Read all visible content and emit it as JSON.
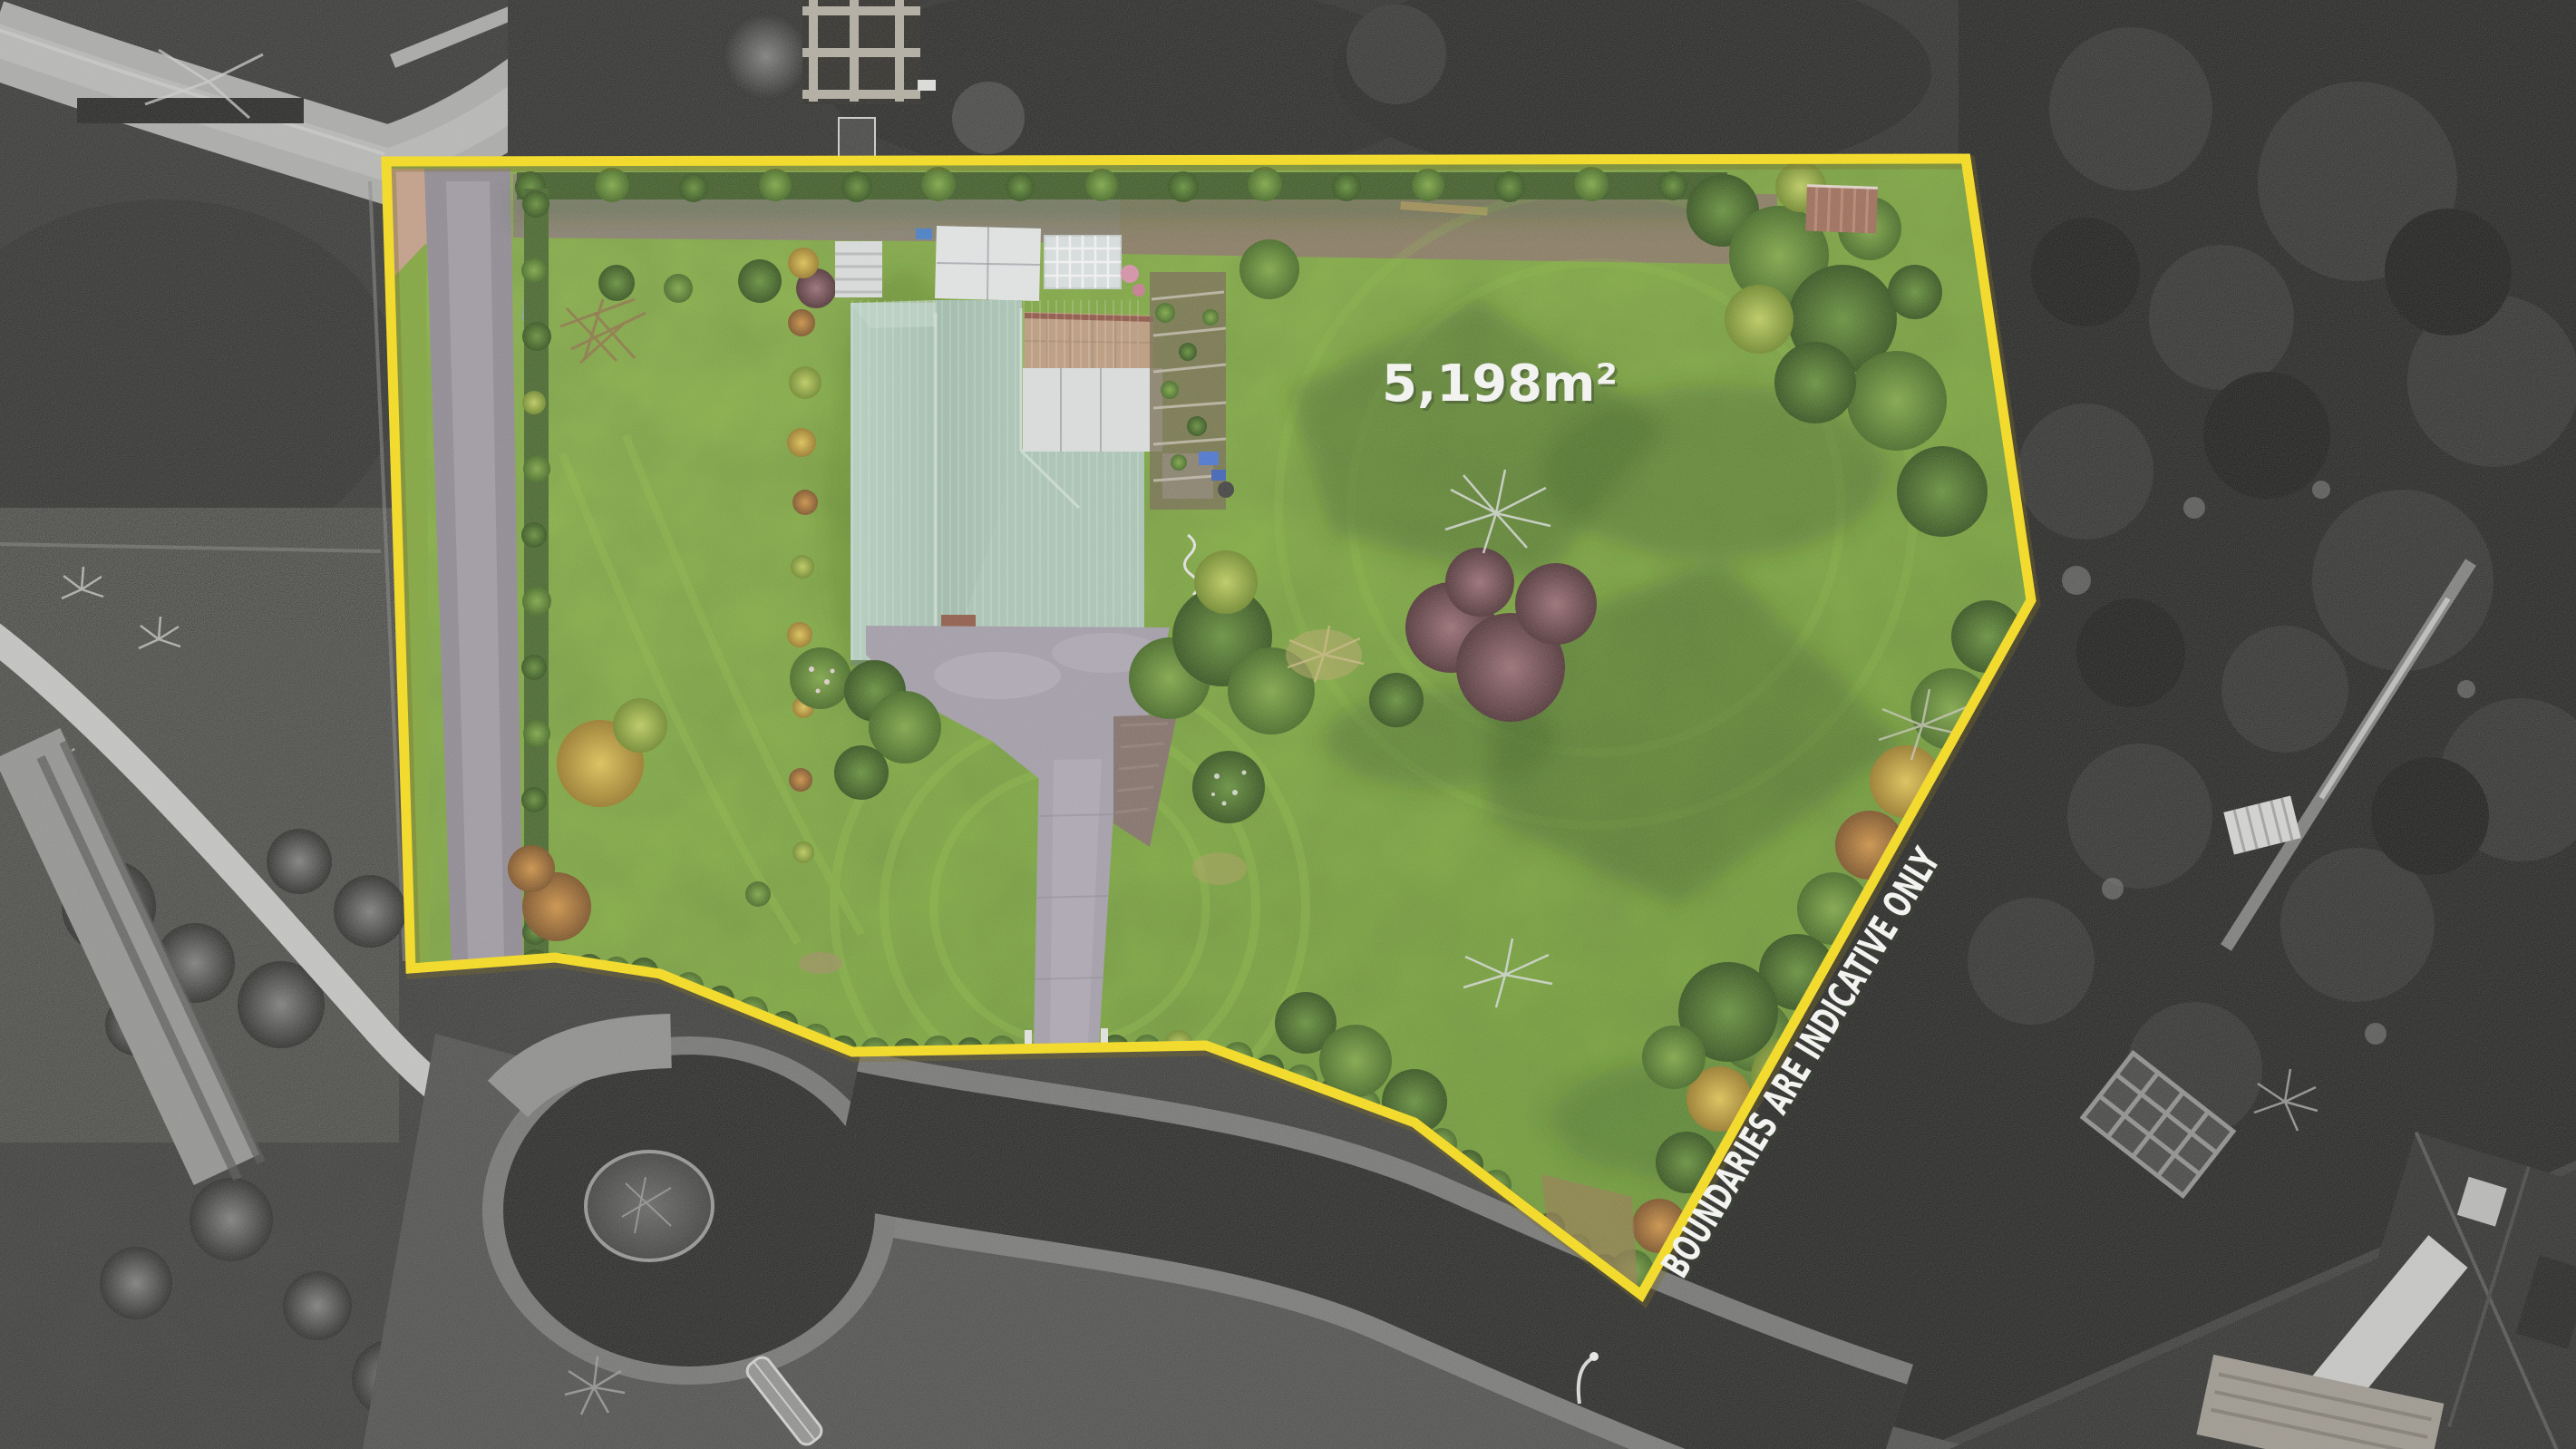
{
  "overlay": {
    "area_label": "5,198m²",
    "disclaimer": "BOUNDARIES ARE INDICATIVE ONLY"
  },
  "colors": {
    "boundary_yellow": "#ffe10a",
    "label_white": "#ffffff",
    "lawn_green": "#7fae36",
    "roof_teal": "#a7c5b6",
    "asphalt_dark": "#1d1d1d"
  }
}
